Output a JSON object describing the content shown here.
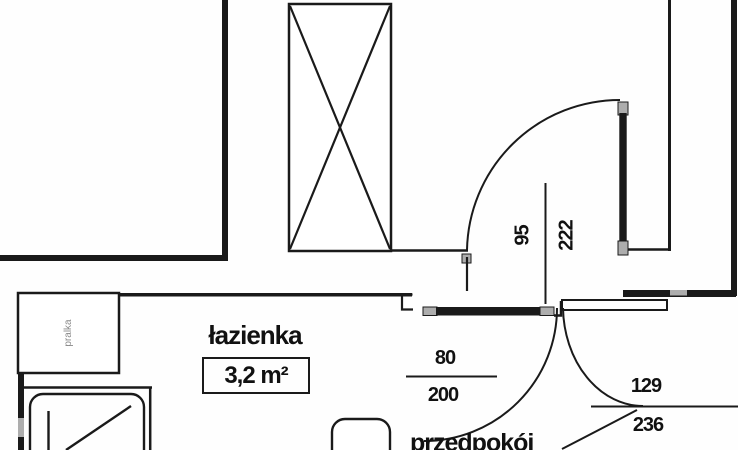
{
  "rooms": {
    "bathroom": {
      "label": "łazienka",
      "area": "3,2 m²"
    },
    "hallway": {
      "label": "przedpokój"
    }
  },
  "appliances": {
    "washing_machine": "pralka"
  },
  "dimensions": {
    "hall_door": {
      "width": "95",
      "height": "222"
    },
    "bath_door": {
      "width": "80",
      "height": "200"
    },
    "entry_door": {
      "width": "129",
      "height": "236"
    }
  },
  "colors": {
    "line": "#1a1a1a",
    "door_cap_gray": "#adadad",
    "label_gray": "#8a8a8a"
  }
}
